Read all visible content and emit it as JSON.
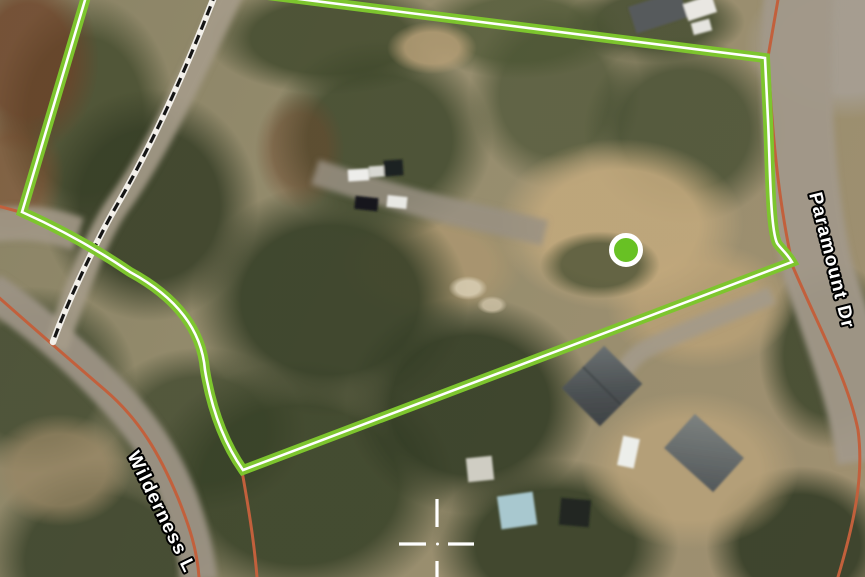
{
  "map": {
    "view": "aerial-parcel-map",
    "labels": {
      "road_1": "Paramount Dr",
      "road_2": "Wilderness L"
    },
    "colors": {
      "boundary-green": "#7dc52e",
      "boundary-core": "#ffffff",
      "road-orange": "#c2603c",
      "road-surface": "#a19889",
      "marker-green": "#68c124",
      "marker-ring": "#ffffff",
      "crosshair-white": "#ffffff",
      "lotline-black": "#141414",
      "lotline-casing": "#f2efe9",
      "label-fill": "#ffffff",
      "label-halo": "#000000"
    }
  }
}
